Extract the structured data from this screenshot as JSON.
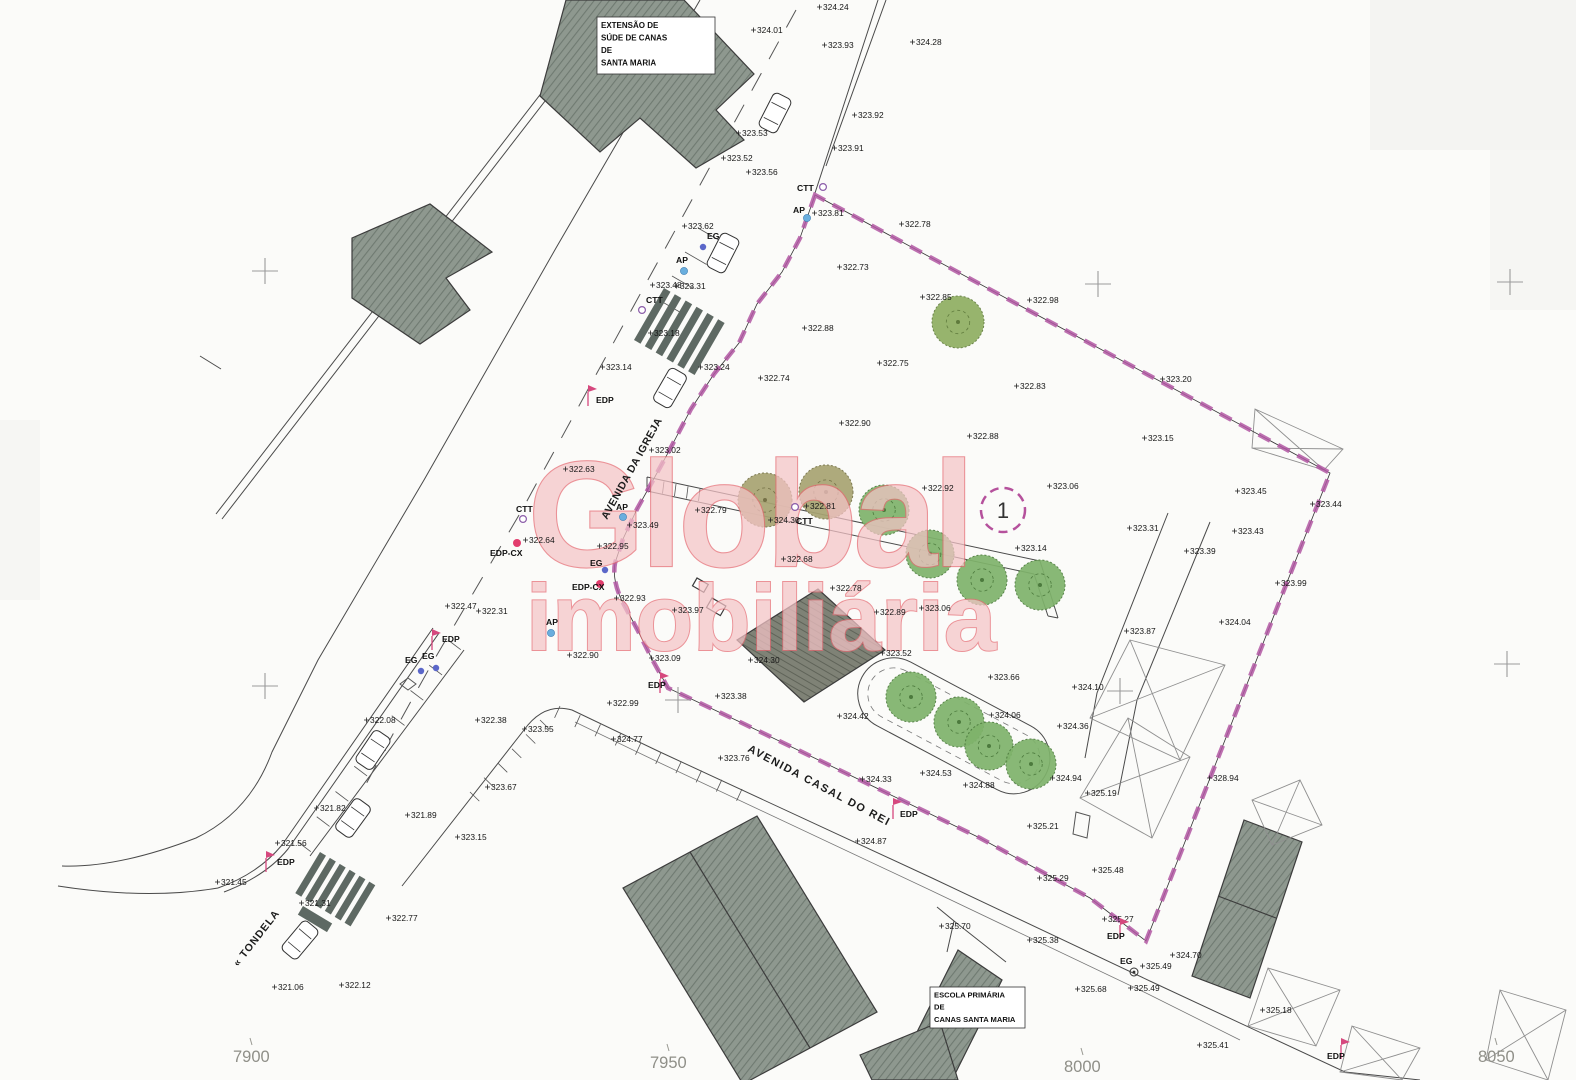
{
  "watermark": {
    "line1": "Global",
    "line2": "imobiliária"
  },
  "parcel": {
    "number": "1"
  },
  "streets": [
    {
      "name": "AVENIDA DA IGREJA",
      "x": 607,
      "y": 520,
      "rotate": -61,
      "size": 10.5,
      "ls": 0.5
    },
    {
      "name": "AVENIDA CASAL DO REI",
      "x": 747,
      "y": 751,
      "rotate": 28,
      "size": 11,
      "ls": 1.5
    },
    {
      "name": "« TONDELA",
      "x": 238,
      "y": 967,
      "rotate": -52,
      "size": 10.5,
      "ls": 1
    }
  ],
  "building_labels": [
    {
      "lines": [
        "EXTENSÃO DE",
        "SÚDE DE CANAS",
        "DE",
        "SANTA MARIA"
      ],
      "x": 597,
      "y": 17,
      "w": 118,
      "h": 57,
      "fs": 8
    },
    {
      "lines": [
        "ESCOLA PRIMÁRIA",
        "DE",
        "CANAS SANTA MARIA"
      ],
      "x": 930,
      "y": 987,
      "w": 95,
      "h": 41,
      "fs": 7.6
    }
  ],
  "grid_coordinates": [
    {
      "t": "7900",
      "x": 233,
      "y": 1062
    },
    {
      "t": "7950",
      "x": 650,
      "y": 1068
    },
    {
      "t": "8000",
      "x": 1064,
      "y": 1072
    },
    {
      "t": "8050",
      "x": 1478,
      "y": 1062
    }
  ],
  "utilities": [
    {
      "t": "CTT",
      "x": 797,
      "y": 191,
      "sx": 823,
      "sy": 187,
      "s": "ctt"
    },
    {
      "t": "AP",
      "x": 793,
      "y": 213,
      "sx": 807,
      "sy": 218,
      "s": "ap"
    },
    {
      "t": "EG",
      "x": 707,
      "y": 239,
      "sx": 703,
      "sy": 247,
      "s": "eg"
    },
    {
      "t": "AP",
      "x": 676,
      "y": 263,
      "sx": 684,
      "sy": 271,
      "s": "ap"
    },
    {
      "t": "CTT",
      "x": 646,
      "y": 303,
      "sx": 642,
      "sy": 310,
      "s": "ctt"
    },
    {
      "t": "EDP",
      "x": 596,
      "y": 403,
      "sx": 588,
      "sy": 397,
      "s": "edp"
    },
    {
      "t": "CTT",
      "x": 516,
      "y": 512,
      "sx": 523,
      "sy": 519,
      "s": "ctt"
    },
    {
      "t": "AP",
      "x": 616,
      "y": 510,
      "sx": 623,
      "sy": 517,
      "s": "ap"
    },
    {
      "t": "CTT",
      "x": 796,
      "y": 524,
      "sx": 795,
      "sy": 507,
      "s": "ctt"
    },
    {
      "t": "EDP-CX",
      "x": 490,
      "y": 556,
      "sx": 517,
      "sy": 543,
      "s": "edpcx"
    },
    {
      "t": "EG",
      "x": 590,
      "y": 566,
      "sx": 605,
      "sy": 570,
      "s": "eg"
    },
    {
      "t": "EDP-CX",
      "x": 572,
      "y": 590,
      "sx": 600,
      "sy": 584,
      "s": "edpcx"
    },
    {
      "t": "AP",
      "x": 546,
      "y": 625,
      "sx": 551,
      "sy": 633,
      "s": "ap"
    },
    {
      "t": "EDP",
      "x": 442,
      "y": 642,
      "sx": 432,
      "sy": 641,
      "s": "edp"
    },
    {
      "t": "EG",
      "x": 405,
      "y": 663,
      "sx": 421,
      "sy": 671,
      "s": "eg"
    },
    {
      "t": "EG",
      "x": 422,
      "y": 659,
      "sx": 436,
      "sy": 668,
      "s": "eg"
    },
    {
      "t": "EDP",
      "x": 277,
      "y": 865,
      "sx": 266,
      "sy": 863,
      "s": "edp"
    },
    {
      "t": "EDP",
      "x": 648,
      "y": 688,
      "sx": 660,
      "sy": 684,
      "s": "edp"
    },
    {
      "t": "EDP",
      "x": 900,
      "y": 817,
      "sx": 893,
      "sy": 810,
      "s": "edp"
    },
    {
      "t": "EDP",
      "x": 1107,
      "y": 939,
      "sx": 1120,
      "sy": 930,
      "s": "edp"
    },
    {
      "t": "EG",
      "x": 1120,
      "y": 964,
      "sx": 1134,
      "sy": 972,
      "s": "egc"
    },
    {
      "t": "EDP",
      "x": 1327,
      "y": 1059,
      "sx": 1341,
      "sy": 1050,
      "s": "edp"
    }
  ],
  "elevations": [
    {
      "t": "324.24",
      "x": 823,
      "y": 10
    },
    {
      "t": "324.01",
      "x": 757,
      "y": 33
    },
    {
      "t": "323.93",
      "x": 828,
      "y": 48
    },
    {
      "t": "324.28",
      "x": 916,
      "y": 45
    },
    {
      "t": "323.92",
      "x": 858,
      "y": 118
    },
    {
      "t": "323.91",
      "x": 838,
      "y": 151
    },
    {
      "t": "323.53",
      "x": 742,
      "y": 136
    },
    {
      "t": "323.52",
      "x": 727,
      "y": 161
    },
    {
      "t": "323.56",
      "x": 752,
      "y": 175
    },
    {
      "t": "323.62",
      "x": 688,
      "y": 229
    },
    {
      "t": "323.81",
      "x": 818,
      "y": 216
    },
    {
      "t": "322.78",
      "x": 905,
      "y": 227
    },
    {
      "t": "322.73",
      "x": 843,
      "y": 270
    },
    {
      "t": "322.98",
      "x": 1033,
      "y": 303
    },
    {
      "t": "322.85",
      "x": 926,
      "y": 300
    },
    {
      "t": "323.20",
      "x": 1166,
      "y": 382
    },
    {
      "t": "322.83",
      "x": 1020,
      "y": 389
    },
    {
      "t": "322.88",
      "x": 808,
      "y": 331
    },
    {
      "t": "322.75",
      "x": 883,
      "y": 366
    },
    {
      "t": "322.74",
      "x": 764,
      "y": 381
    },
    {
      "t": "323.48",
      "x": 656,
      "y": 288
    },
    {
      "t": "323.31",
      "x": 680,
      "y": 289
    },
    {
      "t": "323.18",
      "x": 654,
      "y": 336
    },
    {
      "t": "323.14",
      "x": 606,
      "y": 370
    },
    {
      "t": "323.24",
      "x": 704,
      "y": 370
    },
    {
      "t": "322.90",
      "x": 845,
      "y": 426
    },
    {
      "t": "322.88",
      "x": 973,
      "y": 439
    },
    {
      "t": "323.15",
      "x": 1148,
      "y": 441
    },
    {
      "t": "323.02",
      "x": 655,
      "y": 453
    },
    {
      "t": "322.63",
      "x": 569,
      "y": 472
    },
    {
      "t": "322.92",
      "x": 928,
      "y": 491
    },
    {
      "t": "323.06",
      "x": 1053,
      "y": 489
    },
    {
      "t": "323.45",
      "x": 1241,
      "y": 494
    },
    {
      "t": "323.44",
      "x": 1316,
      "y": 507
    },
    {
      "t": "322.79",
      "x": 701,
      "y": 513
    },
    {
      "t": "322.81",
      "x": 810,
      "y": 509
    },
    {
      "t": "324.30",
      "x": 774,
      "y": 523
    },
    {
      "t": "323.49",
      "x": 633,
      "y": 528
    },
    {
      "t": "322.95",
      "x": 603,
      "y": 549
    },
    {
      "t": "322.64",
      "x": 529,
      "y": 543
    },
    {
      "t": "323.31",
      "x": 1133,
      "y": 531
    },
    {
      "t": "323.14",
      "x": 1021,
      "y": 551
    },
    {
      "t": "323.39",
      "x": 1190,
      "y": 554
    },
    {
      "t": "323.43",
      "x": 1238,
      "y": 534
    },
    {
      "t": "322.90",
      "x": 573,
      "y": 658
    },
    {
      "t": "322.93",
      "x": 620,
      "y": 601
    },
    {
      "t": "323.97",
      "x": 678,
      "y": 613
    },
    {
      "t": "322.47",
      "x": 451,
      "y": 609
    },
    {
      "t": "322.31",
      "x": 482,
      "y": 614
    },
    {
      "t": "322.68",
      "x": 787,
      "y": 562
    },
    {
      "t": "322.78",
      "x": 836,
      "y": 591
    },
    {
      "t": "323.99",
      "x": 1281,
      "y": 586
    },
    {
      "t": "322.89",
      "x": 880,
      "y": 615
    },
    {
      "t": "323.06",
      "x": 925,
      "y": 611
    },
    {
      "t": "323.87",
      "x": 1130,
      "y": 634
    },
    {
      "t": "324.04",
      "x": 1225,
      "y": 625
    },
    {
      "t": "323.52",
      "x": 886,
      "y": 656
    },
    {
      "t": "323.66",
      "x": 994,
      "y": 680
    },
    {
      "t": "324.10",
      "x": 1078,
      "y": 690
    },
    {
      "t": "323.09",
      "x": 655,
      "y": 661
    },
    {
      "t": "324.30",
      "x": 754,
      "y": 663
    },
    {
      "t": "322.08",
      "x": 370,
      "y": 723
    },
    {
      "t": "322.38",
      "x": 481,
      "y": 723
    },
    {
      "t": "323.55",
      "x": 528,
      "y": 732
    },
    {
      "t": "322.99",
      "x": 613,
      "y": 706
    },
    {
      "t": "324.77",
      "x": 617,
      "y": 742
    },
    {
      "t": "323.76",
      "x": 724,
      "y": 761
    },
    {
      "t": "323.67",
      "x": 491,
      "y": 790
    },
    {
      "t": "324.42",
      "x": 843,
      "y": 719
    },
    {
      "t": "324.06",
      "x": 995,
      "y": 718
    },
    {
      "t": "324.36",
      "x": 1063,
      "y": 729
    },
    {
      "t": "323.38",
      "x": 721,
      "y": 699
    },
    {
      "t": "324.33",
      "x": 866,
      "y": 782
    },
    {
      "t": "324.53",
      "x": 926,
      "y": 776
    },
    {
      "t": "324.88",
      "x": 969,
      "y": 788
    },
    {
      "t": "324.94",
      "x": 1056,
      "y": 781
    },
    {
      "t": "324.87",
      "x": 861,
      "y": 844
    },
    {
      "t": "328.94",
      "x": 1213,
      "y": 781
    },
    {
      "t": "325.19",
      "x": 1091,
      "y": 796
    },
    {
      "t": "321.82",
      "x": 320,
      "y": 811
    },
    {
      "t": "321.89",
      "x": 411,
      "y": 818
    },
    {
      "t": "323.15",
      "x": 461,
      "y": 840
    },
    {
      "t": "321.56",
      "x": 281,
      "y": 846
    },
    {
      "t": "321.45",
      "x": 221,
      "y": 885
    },
    {
      "t": "321.31",
      "x": 305,
      "y": 906
    },
    {
      "t": "322.77",
      "x": 392,
      "y": 921
    },
    {
      "t": "321.06",
      "x": 278,
      "y": 990
    },
    {
      "t": "322.12",
      "x": 345,
      "y": 988
    },
    {
      "t": "325.21",
      "x": 1033,
      "y": 829
    },
    {
      "t": "325.48",
      "x": 1098,
      "y": 873
    },
    {
      "t": "325.29",
      "x": 1043,
      "y": 881
    },
    {
      "t": "325.27",
      "x": 1108,
      "y": 922
    },
    {
      "t": "325.38",
      "x": 1033,
      "y": 943
    },
    {
      "t": "325.70",
      "x": 945,
      "y": 929
    },
    {
      "t": "325.49",
      "x": 1146,
      "y": 969
    },
    {
      "t": "325.49",
      "x": 1134,
      "y": 991
    },
    {
      "t": "325.68",
      "x": 1081,
      "y": 992
    },
    {
      "t": "324.70",
      "x": 1176,
      "y": 958
    },
    {
      "t": "325.18",
      "x": 1266,
      "y": 1013
    },
    {
      "t": "325.41",
      "x": 1203,
      "y": 1048
    }
  ],
  "colors": {
    "boundary": "#b157a3",
    "building_fill": "#8e988f",
    "tree_green": "#7fb36b",
    "watermark_fill": "#f5c4c7",
    "watermark_stroke": "#e56a72"
  }
}
